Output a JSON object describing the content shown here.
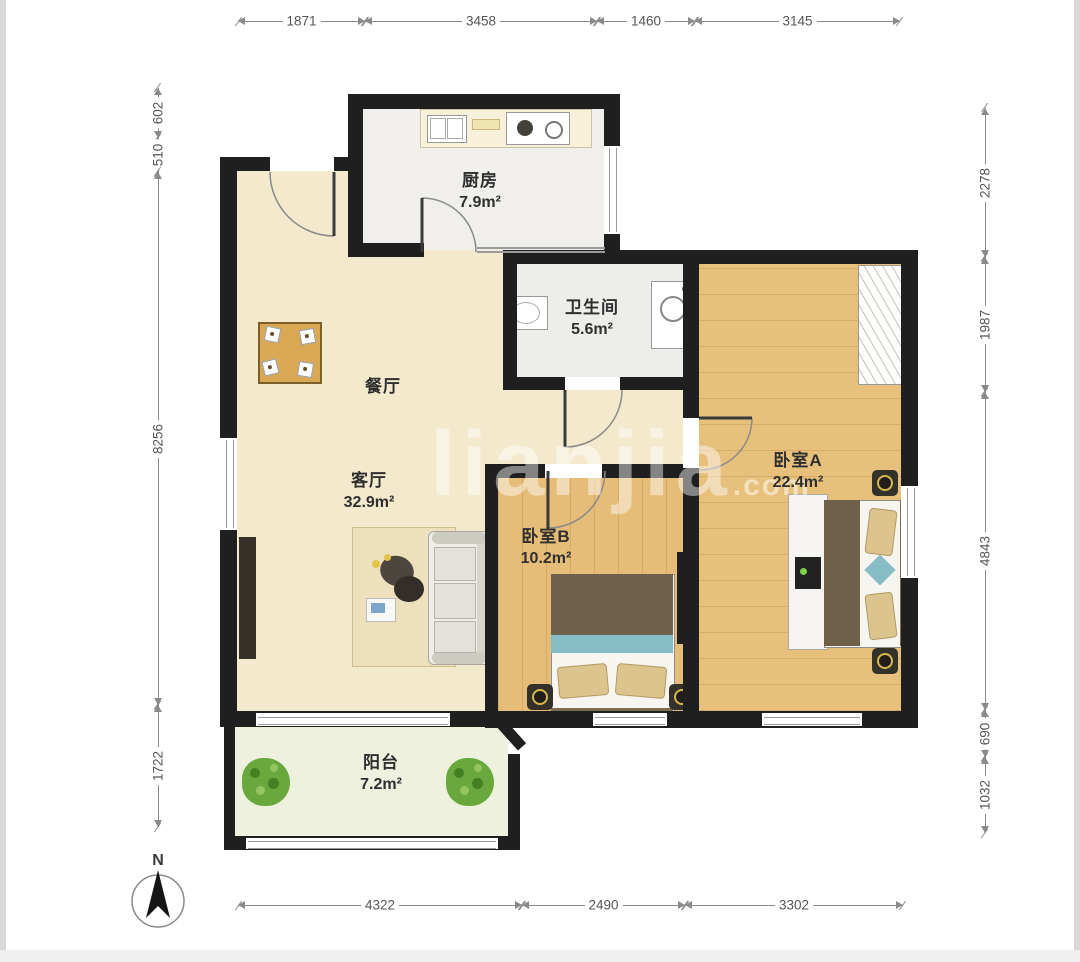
{
  "plan": {
    "rooms": {
      "kitchen": {
        "name": "厨房",
        "area": "7.9m²"
      },
      "bathroom": {
        "name": "卫生间",
        "area": "5.6m²"
      },
      "dining": {
        "name": "餐厅"
      },
      "living": {
        "name": "客厅",
        "area": "32.9m²"
      },
      "bedroom_b": {
        "name": "卧室B",
        "area": "10.2m²"
      },
      "bedroom_a": {
        "name": "卧室A",
        "area": "22.4m²"
      },
      "balcony": {
        "name": "阳台",
        "area": "7.2m²"
      }
    },
    "dimensions_mm": {
      "top": [
        "1871",
        "3458",
        "1460",
        "3145"
      ],
      "bottom": [
        "4322",
        "2490",
        "3302"
      ],
      "left": [
        "602",
        "510",
        "8256",
        "1722"
      ],
      "right": [
        "2278",
        "1987",
        "4843",
        "690",
        "1032"
      ]
    },
    "compass": {
      "label": "N"
    },
    "watermark": {
      "text": "lianjia",
      "suffix": ".com"
    },
    "colors": {
      "wall": "#1f1f1f",
      "living_floor": "#f3e9cd",
      "wood_floor": "#e5bd78",
      "tile_floor": "#f0efeb",
      "balcony_floor": "#edf1de"
    }
  }
}
